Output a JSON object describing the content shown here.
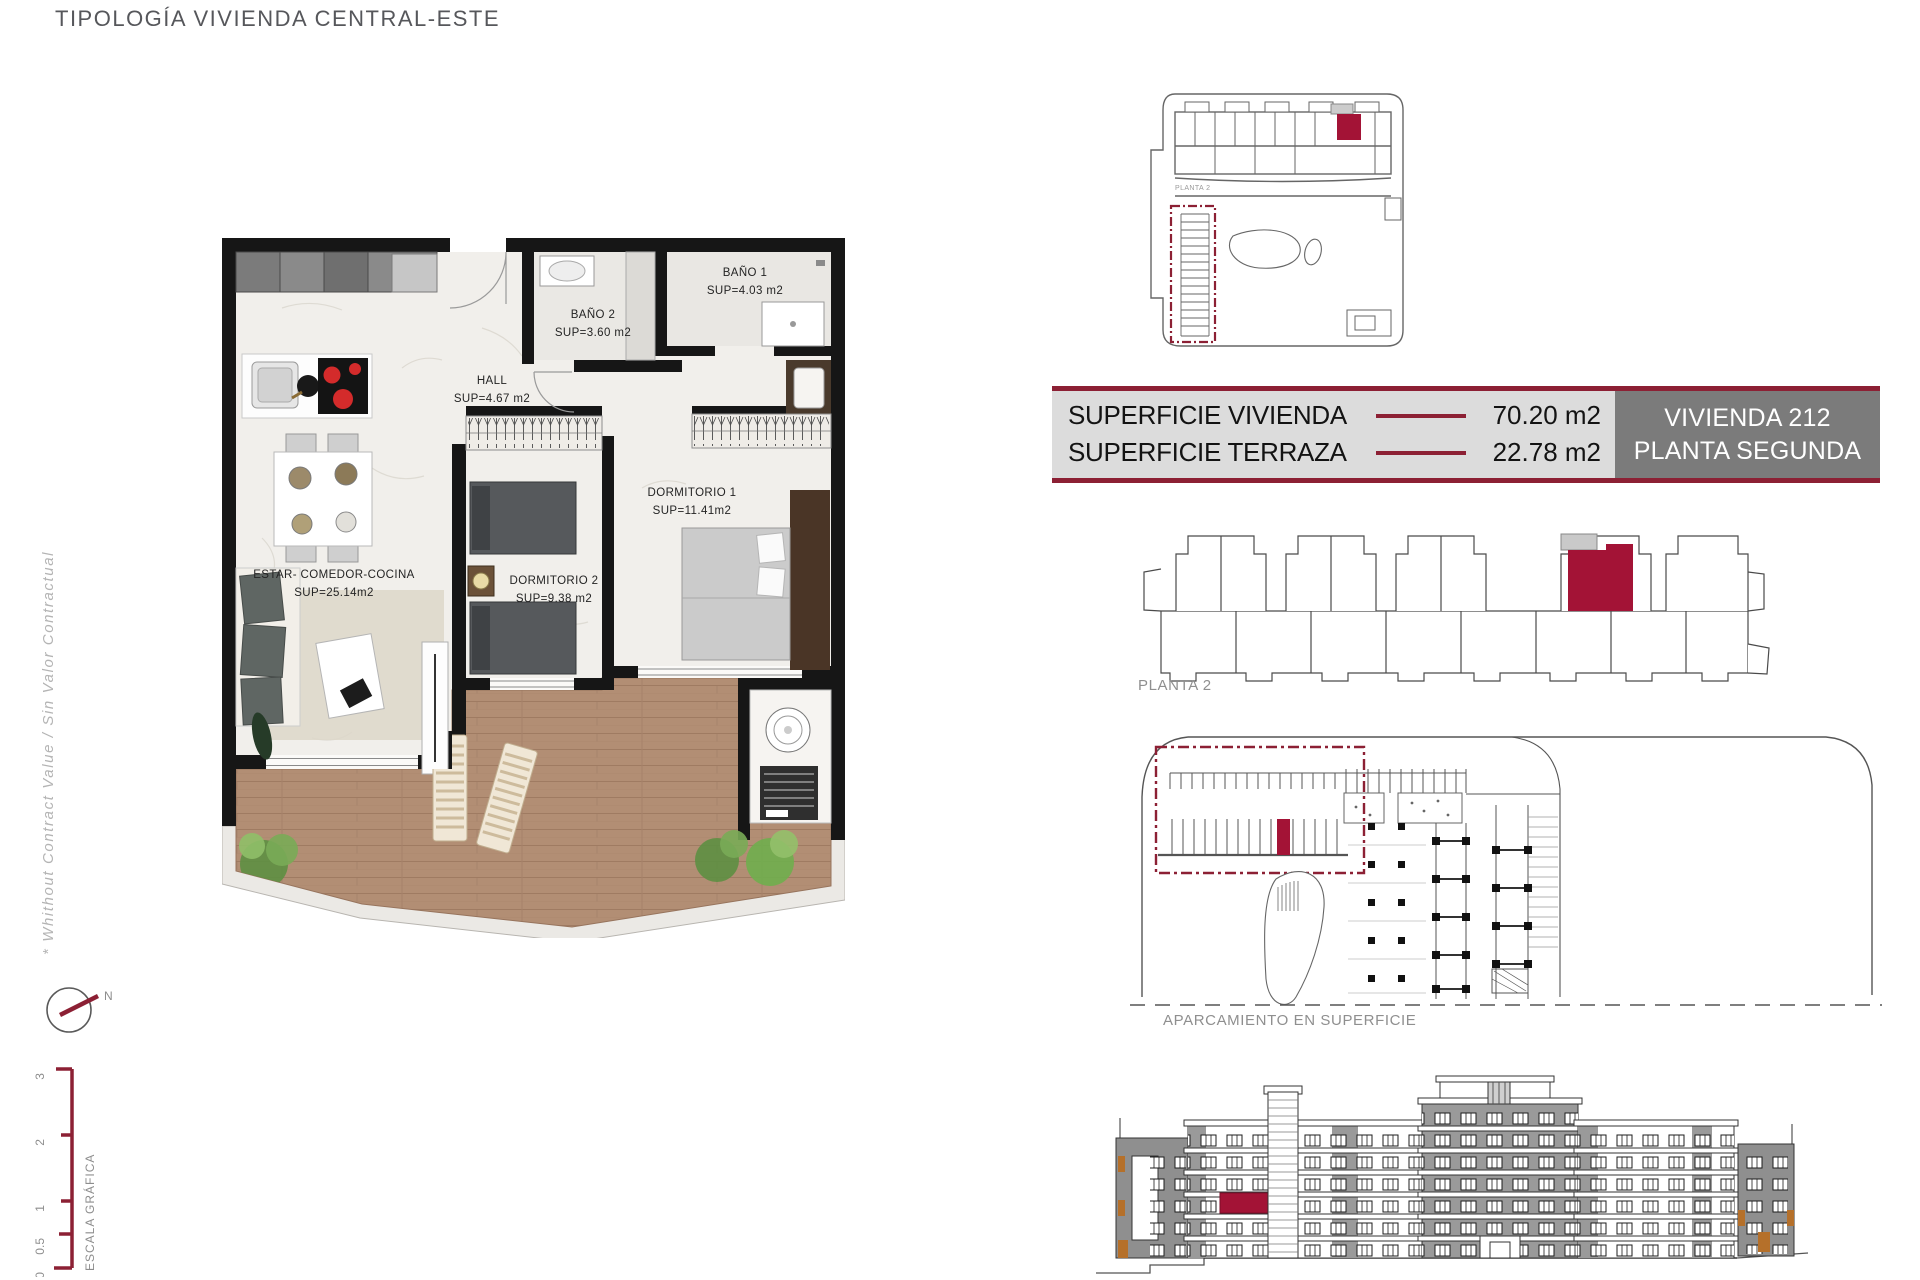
{
  "title": "TIPOLOGÍA VIVIENDA CENTRAL-ESTE",
  "side_note": "* Whithout Contract Value / Sin Valor Contractual",
  "compass": {
    "north": "N"
  },
  "scale_bar": {
    "label": "ESCALA GRÁFICA",
    "ticks": [
      "3",
      "2",
      "1",
      "0.5",
      "0"
    ]
  },
  "floor_plan": {
    "rooms": [
      {
        "name": "ESTAR-  COMEDOR-COCINA",
        "area": "SUP=25.14m2"
      },
      {
        "name": "HALL",
        "area": "SUP=4.67  m2"
      },
      {
        "name": "BAÑO  2",
        "area": "SUP=3.60  m2"
      },
      {
        "name": "BAÑO  1",
        "area": "SUP=4.03  m2"
      },
      {
        "name": "DORMITORIO  2",
        "area": "SUP=9.38  m2"
      },
      {
        "name": "DORMITORIO  1",
        "area": "SUP=11.41m2"
      }
    ]
  },
  "site_plan": {
    "small_label": "PLANTA 2"
  },
  "key_plan": {
    "label": "PLANTA 2"
  },
  "parking": {
    "label": "APARCAMIENTO EN SUPERFICIE"
  },
  "summary": {
    "rows": [
      {
        "label": "SUPERFICIE VIVIENDA",
        "value": "70.20 m2"
      },
      {
        "label": "SUPERFICIE TERRAZA",
        "value": "22.78 m2"
      }
    ],
    "unit": "VIVIENDA 212",
    "floor": "PLANTA SEGUNDA"
  },
  "colors": {
    "accent_maroon": "#8c2034",
    "highlight_red": "#a31336",
    "table_light_gray": "#dcdcdc",
    "table_dark_gray": "#7b7b7b",
    "accent_orange": "#b5702a"
  }
}
